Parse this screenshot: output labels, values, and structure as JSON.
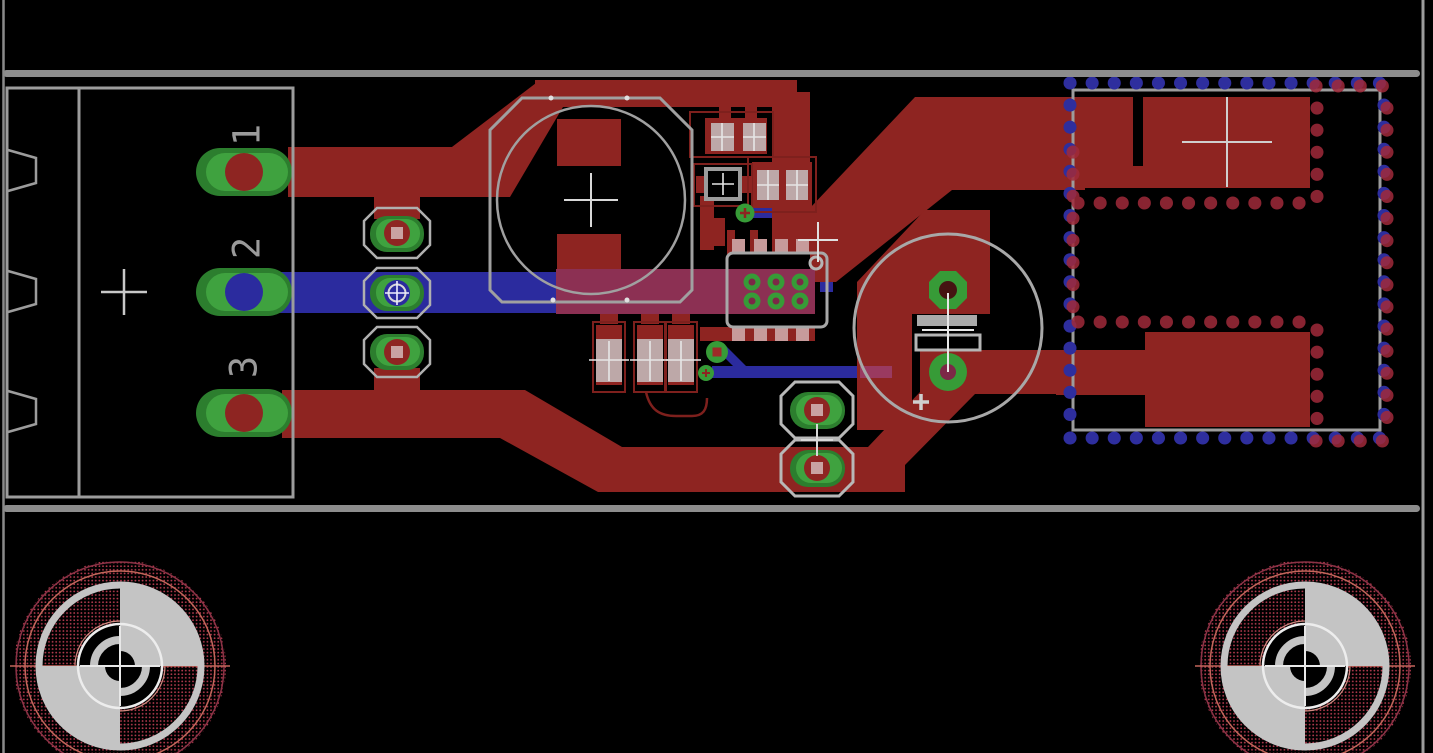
{
  "title": "pcb-board-layout-view",
  "canvas": {
    "width": 1433,
    "height": 753,
    "background": "#000000"
  },
  "colors": {
    "top_copper_red": "#8e2421",
    "bottom_copper_blue": "#2b2b9e",
    "layer_overlap_maroon": "#8c3053",
    "pad_green": "#379b37",
    "outline_gray": "#9c9c9c",
    "drill_pink": "#c9a2a2",
    "keepout_dot_red": "#a02a3a",
    "keepout_dot_blue": "#2e2e9e",
    "fiducial_stipple_red": "#b23a4e",
    "board_edge_gray": "#8d8d8d"
  },
  "connector": {
    "name": "3-pin-power-connector",
    "pins": [
      {
        "label": "1"
      },
      {
        "label": "2"
      },
      {
        "label": "3"
      }
    ]
  },
  "electrolytic_capacitor": {
    "polarity_label": "+"
  },
  "components": {
    "large_round_capacitor": "round-smd-capacitor",
    "ic": "6-pad-thermal-ic",
    "passives": [
      "smd-passive-1",
      "smd-passive-2",
      "smd-passive-3",
      "smd-passive-4",
      "smd-passive-5",
      "smd-passive-6"
    ],
    "module": "rf-module-with-keepout",
    "fiducials": [
      "bottom-left-target",
      "bottom-right-target"
    ]
  }
}
